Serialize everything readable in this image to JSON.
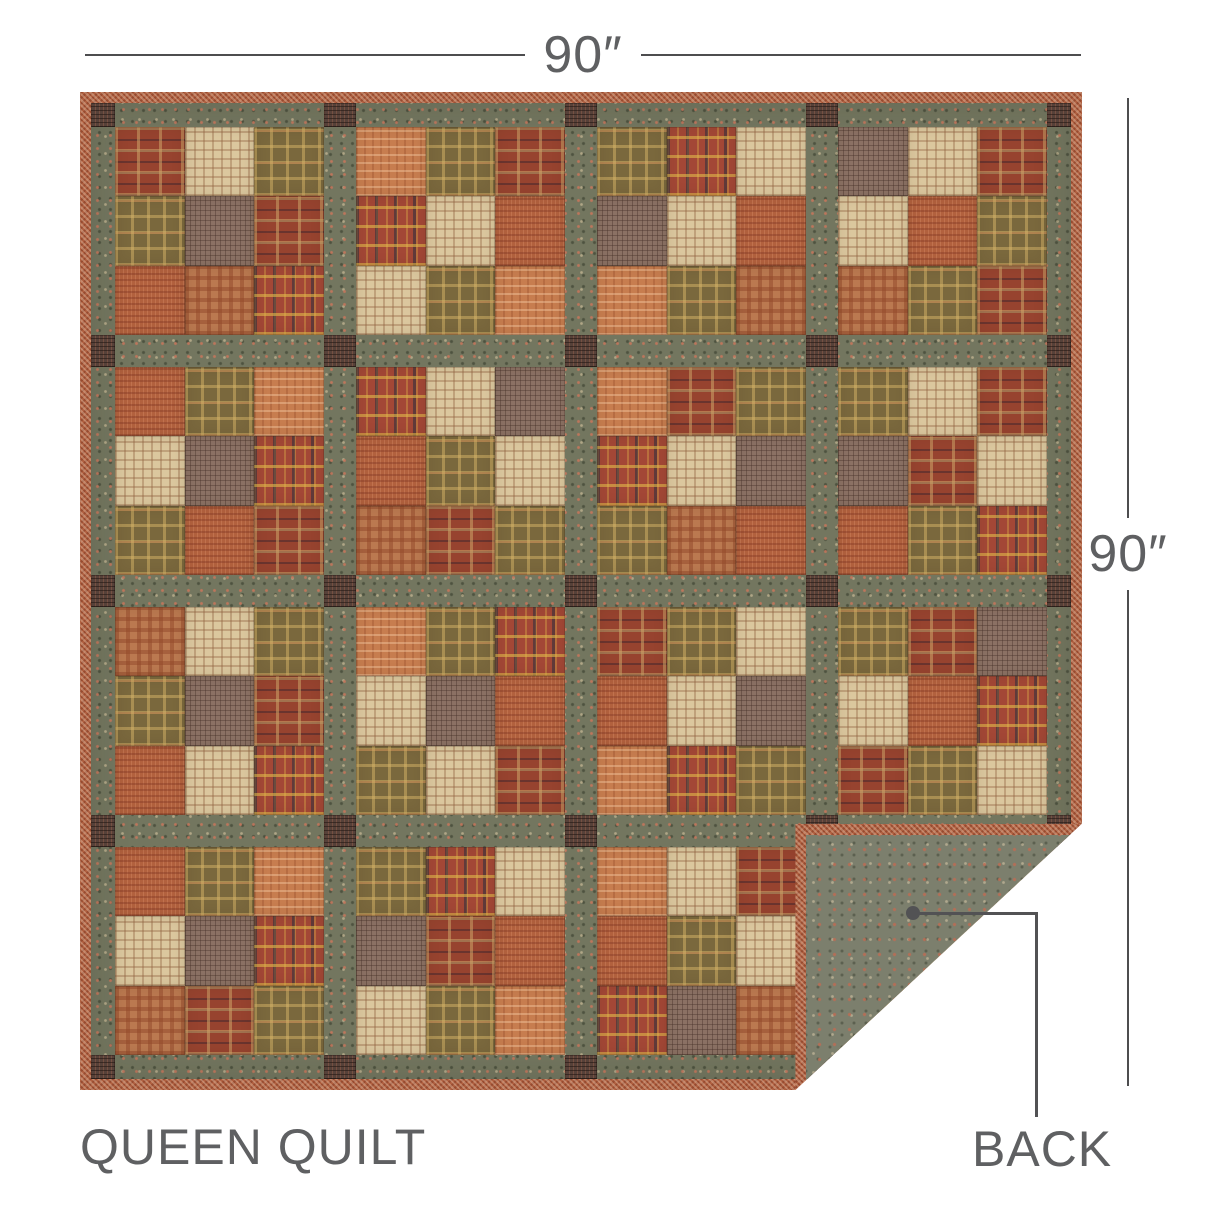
{
  "labels": {
    "top_dimension": "90″",
    "right_dimension": "90″",
    "product_name": "QUEEN QUILT",
    "back_label": "BACK"
  },
  "colors": {
    "background": "#ffffff",
    "label_text": "#5f6062",
    "dimension_line": "#4d4d4f",
    "pointer": "#525254",
    "sashing": "#73765f",
    "corner_post": "#564139",
    "binding": "#b06040",
    "backing": "#7c7f6d"
  },
  "fabric_legend": {
    "A": "maroon-tan plaid",
    "B": "cream-tan check",
    "C": "olive-gold plaid",
    "D": "mauve-brown fine check",
    "E": "rust weave",
    "F": "orange check",
    "G": "red multicolor plaid",
    "H": "rust gingham"
  },
  "quilt": {
    "layout": "4x4 blocks of 3x3 patches with floral sashing, check corner posts, gingham binding, bottom-right corner folded showing backing",
    "blocks": [
      [
        "A",
        "B",
        "C",
        "C",
        "D",
        "A",
        "E",
        "H",
        "G"
      ],
      [
        "F",
        "C",
        "A",
        "G",
        "B",
        "E",
        "B",
        "C",
        "F"
      ],
      [
        "C",
        "G",
        "B",
        "D",
        "B",
        "E",
        "F",
        "C",
        "H"
      ],
      [
        "D",
        "B",
        "A",
        "B",
        "E",
        "C",
        "H",
        "C",
        "A"
      ],
      [
        "E",
        "C",
        "F",
        "B",
        "D",
        "G",
        "C",
        "E",
        "A"
      ],
      [
        "G",
        "B",
        "D",
        "E",
        "C",
        "B",
        "H",
        "A",
        "C"
      ],
      [
        "F",
        "A",
        "C",
        "G",
        "B",
        "D",
        "C",
        "H",
        "E"
      ],
      [
        "C",
        "B",
        "A",
        "D",
        "A",
        "B",
        "E",
        "C",
        "G"
      ],
      [
        "H",
        "B",
        "C",
        "C",
        "D",
        "A",
        "E",
        "B",
        "G"
      ],
      [
        "F",
        "C",
        "G",
        "B",
        "D",
        "E",
        "C",
        "B",
        "A"
      ],
      [
        "A",
        "C",
        "B",
        "E",
        "B",
        "D",
        "F",
        "G",
        "C"
      ],
      [
        "C",
        "A",
        "D",
        "B",
        "E",
        "G",
        "A",
        "C",
        "B"
      ],
      [
        "E",
        "C",
        "F",
        "B",
        "D",
        "G",
        "H",
        "A",
        "C"
      ],
      [
        "C",
        "G",
        "B",
        "D",
        "A",
        "E",
        "B",
        "C",
        "F"
      ],
      [
        "F",
        "B",
        "A",
        "E",
        "C",
        "B",
        "G",
        "D",
        "H"
      ],
      [
        "A",
        "C",
        "B",
        "G",
        "B",
        "E",
        "C",
        "F",
        "D"
      ]
    ]
  }
}
